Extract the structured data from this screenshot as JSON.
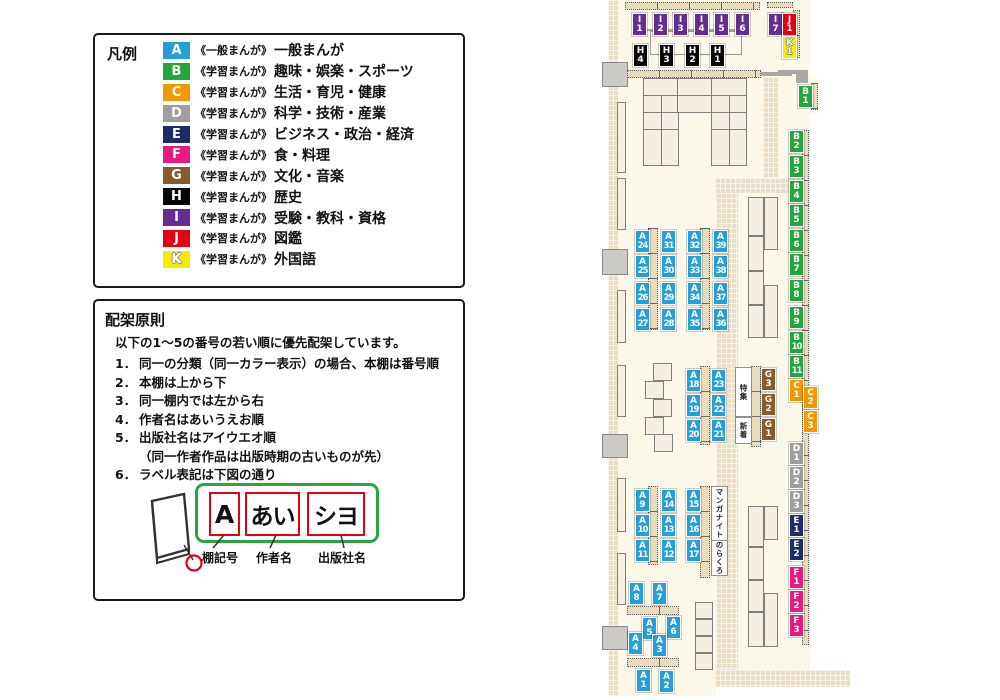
{
  "legend": {
    "title": "凡例",
    "items": [
      {
        "code": "A",
        "color": "#259fd8",
        "scope": "《一般まんが》",
        "category": "一般まんが",
        "outlined": false
      },
      {
        "code": "B",
        "color": "#23a73d",
        "scope": "《学習まんが》",
        "category": "趣味・娯楽・スポーツ",
        "outlined": false
      },
      {
        "code": "C",
        "color": "#f39800",
        "scope": "《学習まんが》",
        "category": "生活・育児・健康",
        "outlined": false
      },
      {
        "code": "D",
        "color": "#9e9e9f",
        "scope": "《学習まんが》",
        "category": "科学・技術・産業",
        "outlined": false
      },
      {
        "code": "E",
        "color": "#1d2b67",
        "scope": "《学習まんが》",
        "category": "ビジネス・政治・経済",
        "outlined": false
      },
      {
        "code": "F",
        "color": "#e9197d",
        "scope": "《学習まんが》",
        "category": "食・料理",
        "outlined": false
      },
      {
        "code": "G",
        "color": "#8a5b2a",
        "scope": "《学習まんが》",
        "category": "文化・音楽",
        "outlined": false
      },
      {
        "code": "H",
        "color": "#070707",
        "scope": "《学習まんが》",
        "category": "歴史",
        "outlined": false
      },
      {
        "code": "I",
        "color": "#662d91",
        "scope": "《学習まんが》",
        "category": "受験・教科・資格",
        "outlined": false
      },
      {
        "code": "J",
        "color": "#e60012",
        "scope": "《学習まんが》",
        "category": "図鑑",
        "outlined": false
      },
      {
        "code": "K",
        "color": "#f7ec00",
        "scope": "《学習まんが》",
        "category": "外国語",
        "outlined": true
      }
    ]
  },
  "principles": {
    "title": "配架原則",
    "intro": "以下の1～5の番号の若い順に優先配架しています。",
    "rules": [
      {
        "num": "1．",
        "text": "同一の分類（同一カラー表示）の場合、本棚は番号順",
        "indent": false
      },
      {
        "num": "2．",
        "text": "本棚は上から下",
        "indent": false
      },
      {
        "num": "3．",
        "text": "同一棚内では左から右",
        "indent": false
      },
      {
        "num": "4．",
        "text": "作者名はあいうえお順",
        "indent": false
      },
      {
        "num": "5．",
        "text": "出版社名はアイウエオ順",
        "indent": false
      },
      {
        "num": "",
        "text": "（同一作者作品は出版時期の古いものが先）",
        "indent": true
      },
      {
        "num": "6．",
        "text": "ラベル表記は下図の通り",
        "indent": false
      }
    ],
    "label_example": {
      "shelf_code": "A",
      "author": "あい",
      "publisher": "シヨ"
    },
    "label_captions": [
      {
        "text": "棚記号",
        "x": 202,
        "y": 549
      },
      {
        "text": "作者名",
        "x": 256,
        "y": 549
      },
      {
        "text": "出版社名",
        "x": 318,
        "y": 549
      }
    ]
  },
  "map": {
    "area_labels": [
      {
        "name": "feature",
        "text": "特集",
        "x": 735,
        "y": 367,
        "w": 15,
        "h": 48
      },
      {
        "name": "new-arrivals",
        "text": "新着",
        "x": 735,
        "y": 417,
        "w": 15,
        "h": 25
      },
      {
        "name": "manga-night",
        "text": "マンガナイト",
        "x": 711,
        "y": 486,
        "w": 15,
        "h": 53
      },
      {
        "name": "norakuro",
        "text": "のらくろ",
        "x": 711,
        "y": 540,
        "w": 15,
        "h": 34
      }
    ],
    "shelf_labels": [
      {
        "code": "I",
        "num": "1",
        "x": 632,
        "y": 13
      },
      {
        "code": "I",
        "num": "2",
        "x": 653,
        "y": 13
      },
      {
        "code": "I",
        "num": "3",
        "x": 673,
        "y": 13
      },
      {
        "code": "I",
        "num": "4",
        "x": 694,
        "y": 13
      },
      {
        "code": "I",
        "num": "5",
        "x": 714,
        "y": 13
      },
      {
        "code": "I",
        "num": "6",
        "x": 735,
        "y": 13
      },
      {
        "code": "I",
        "num": "7",
        "x": 768,
        "y": 13
      },
      {
        "code": "J",
        "num": "1",
        "x": 782,
        "y": 13
      },
      {
        "code": "K",
        "num": "1",
        "x": 782,
        "y": 36
      },
      {
        "code": "H",
        "num": "4",
        "x": 633,
        "y": 44
      },
      {
        "code": "H",
        "num": "3",
        "x": 659,
        "y": 44
      },
      {
        "code": "H",
        "num": "2",
        "x": 685,
        "y": 44
      },
      {
        "code": "H",
        "num": "1",
        "x": 710,
        "y": 44
      },
      {
        "code": "B",
        "num": "1",
        "x": 798,
        "y": 85
      },
      {
        "code": "B",
        "num": "2",
        "x": 789,
        "y": 130
      },
      {
        "code": "B",
        "num": "3",
        "x": 789,
        "y": 155
      },
      {
        "code": "B",
        "num": "4",
        "x": 789,
        "y": 180
      },
      {
        "code": "B",
        "num": "5",
        "x": 789,
        "y": 204
      },
      {
        "code": "B",
        "num": "6",
        "x": 789,
        "y": 229
      },
      {
        "code": "B",
        "num": "7",
        "x": 789,
        "y": 253
      },
      {
        "code": "B",
        "num": "8",
        "x": 789,
        "y": 279
      },
      {
        "code": "B",
        "num": "9",
        "x": 789,
        "y": 306
      },
      {
        "code": "B",
        "num": "10",
        "x": 789,
        "y": 331
      },
      {
        "code": "B",
        "num": "11",
        "x": 789,
        "y": 355
      },
      {
        "code": "C",
        "num": "1",
        "x": 789,
        "y": 379
      },
      {
        "code": "C",
        "num": "2",
        "x": 803,
        "y": 386
      },
      {
        "code": "C",
        "num": "3",
        "x": 803,
        "y": 410
      },
      {
        "code": "D",
        "num": "1",
        "x": 789,
        "y": 442
      },
      {
        "code": "D",
        "num": "2",
        "x": 789,
        "y": 466
      },
      {
        "code": "D",
        "num": "3",
        "x": 789,
        "y": 490
      },
      {
        "code": "E",
        "num": "1",
        "x": 789,
        "y": 514
      },
      {
        "code": "E",
        "num": "2",
        "x": 789,
        "y": 538
      },
      {
        "code": "F",
        "num": "1",
        "x": 789,
        "y": 566
      },
      {
        "code": "F",
        "num": "2",
        "x": 789,
        "y": 590
      },
      {
        "code": "F",
        "num": "3",
        "x": 789,
        "y": 614
      },
      {
        "code": "G",
        "num": "3",
        "x": 761,
        "y": 368
      },
      {
        "code": "G",
        "num": "2",
        "x": 761,
        "y": 393
      },
      {
        "code": "G",
        "num": "1",
        "x": 761,
        "y": 418
      },
      {
        "code": "A",
        "num": "24",
        "x": 635,
        "y": 230
      },
      {
        "code": "A",
        "num": "31",
        "x": 661,
        "y": 230
      },
      {
        "code": "A",
        "num": "25",
        "x": 635,
        "y": 255
      },
      {
        "code": "A",
        "num": "30",
        "x": 661,
        "y": 255
      },
      {
        "code": "A",
        "num": "26",
        "x": 635,
        "y": 282
      },
      {
        "code": "A",
        "num": "29",
        "x": 661,
        "y": 282
      },
      {
        "code": "A",
        "num": "27",
        "x": 635,
        "y": 308
      },
      {
        "code": "A",
        "num": "28",
        "x": 661,
        "y": 308
      },
      {
        "code": "A",
        "num": "32",
        "x": 687,
        "y": 230
      },
      {
        "code": "A",
        "num": "39",
        "x": 713,
        "y": 230
      },
      {
        "code": "A",
        "num": "33",
        "x": 687,
        "y": 255
      },
      {
        "code": "A",
        "num": "38",
        "x": 713,
        "y": 255
      },
      {
        "code": "A",
        "num": "34",
        "x": 687,
        "y": 282
      },
      {
        "code": "A",
        "num": "37",
        "x": 713,
        "y": 282
      },
      {
        "code": "A",
        "num": "35",
        "x": 687,
        "y": 308
      },
      {
        "code": "A",
        "num": "36",
        "x": 713,
        "y": 308
      },
      {
        "code": "A",
        "num": "18",
        "x": 686,
        "y": 369
      },
      {
        "code": "A",
        "num": "23",
        "x": 711,
        "y": 369
      },
      {
        "code": "A",
        "num": "19",
        "x": 686,
        "y": 394
      },
      {
        "code": "A",
        "num": "22",
        "x": 711,
        "y": 394
      },
      {
        "code": "A",
        "num": "20",
        "x": 686,
        "y": 419
      },
      {
        "code": "A",
        "num": "21",
        "x": 711,
        "y": 419
      },
      {
        "code": "A",
        "num": "9",
        "x": 635,
        "y": 489
      },
      {
        "code": "A",
        "num": "14",
        "x": 661,
        "y": 489
      },
      {
        "code": "A",
        "num": "10",
        "x": 635,
        "y": 514
      },
      {
        "code": "A",
        "num": "13",
        "x": 661,
        "y": 514
      },
      {
        "code": "A",
        "num": "11",
        "x": 635,
        "y": 539
      },
      {
        "code": "A",
        "num": "12",
        "x": 661,
        "y": 539
      },
      {
        "code": "A",
        "num": "15",
        "x": 686,
        "y": 489
      },
      {
        "code": "A",
        "num": "16",
        "x": 686,
        "y": 514
      },
      {
        "code": "A",
        "num": "17",
        "x": 686,
        "y": 539
      },
      {
        "code": "A",
        "num": "8",
        "x": 629,
        "y": 582
      },
      {
        "code": "A",
        "num": "7",
        "x": 652,
        "y": 582
      },
      {
        "code": "A",
        "num": "5",
        "x": 642,
        "y": 617
      },
      {
        "code": "A",
        "num": "6",
        "x": 666,
        "y": 616
      },
      {
        "code": "A",
        "num": "4",
        "x": 628,
        "y": 632
      },
      {
        "code": "A",
        "num": "3",
        "x": 652,
        "y": 634
      },
      {
        "code": "A",
        "num": "1",
        "x": 636,
        "y": 669
      },
      {
        "code": "A",
        "num": "2",
        "x": 659,
        "y": 670
      }
    ]
  }
}
